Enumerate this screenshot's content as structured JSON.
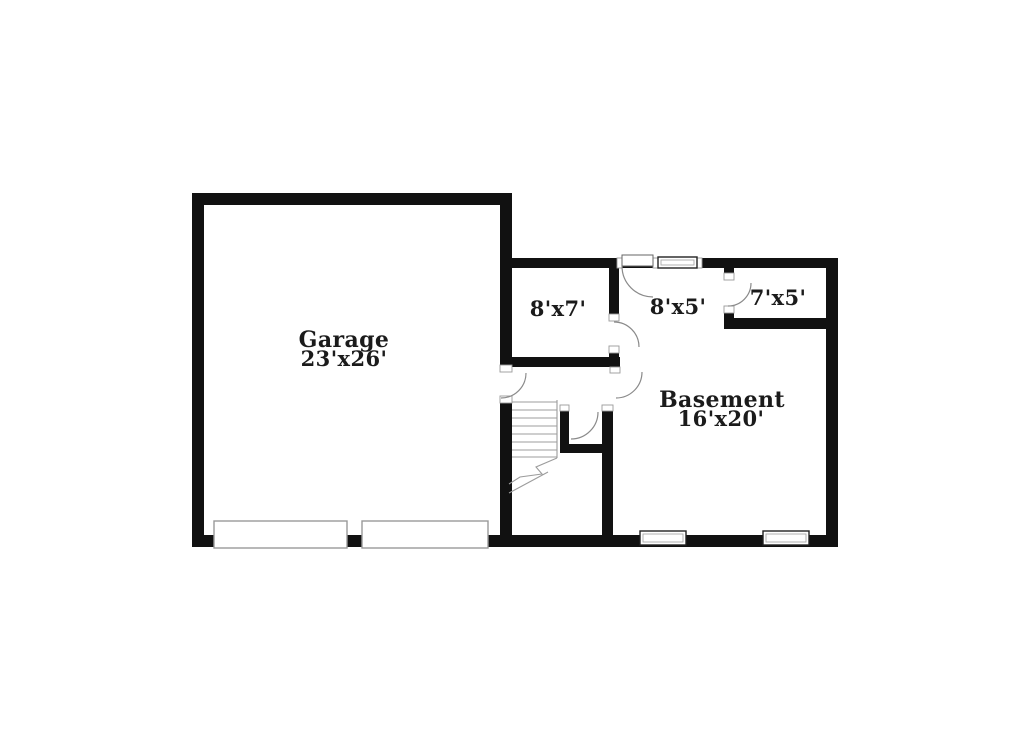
{
  "image_type": "basement floor plan",
  "colors": {
    "background": "#ffffff",
    "wall": "#111111",
    "door_swing": "#8a8a8a",
    "stair_line": "#9c9c9c",
    "window_frame": "#222222",
    "opening_outline": "#9a9a9a",
    "text": "#1b1b1b"
  },
  "rooms": {
    "garage": {
      "name": "Garage",
      "dimensions": "23'x26'"
    },
    "storage_8x7": {
      "label": "8'x7'"
    },
    "storage_8x5": {
      "label": "8'x5'"
    },
    "storage_7x5": {
      "label": "7'x5'"
    },
    "basement": {
      "name": "Basement",
      "dimensions": "16'x20'"
    }
  }
}
